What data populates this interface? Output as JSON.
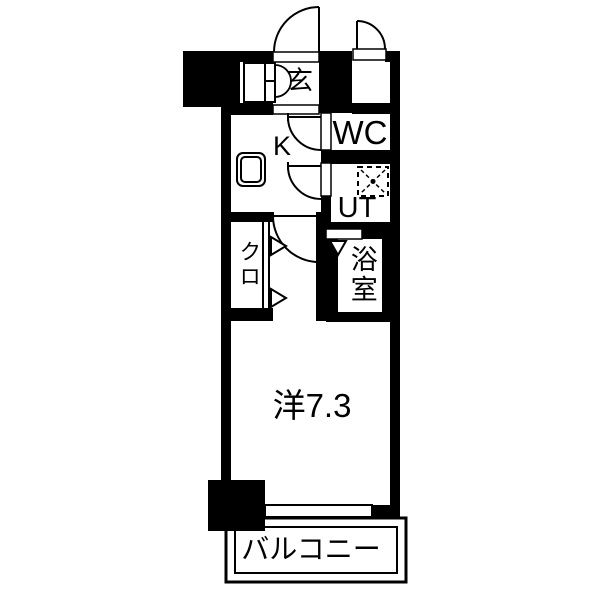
{
  "title": "apartment-floor-plan",
  "colors": {
    "wall": "#000000",
    "background": "#ffffff",
    "line": "#000000"
  },
  "rooms": {
    "genkan": {
      "label": "玄"
    },
    "kitchen": {
      "label": "K"
    },
    "wc": {
      "label": "WC"
    },
    "utility": {
      "label": "UT"
    },
    "bath": {
      "label": "浴室"
    },
    "closet": {
      "label": "クロ"
    },
    "main_room": {
      "label": "洋7.3"
    },
    "balcony": {
      "label": "バルコニー"
    }
  },
  "symbols": {
    "entrance_door": "swing-door-arc",
    "meter_box_door": "swing-door-arc",
    "wc_door": "swing-door-arc",
    "utility_door": "swing-door-arc",
    "room_door": "swing-door-arc",
    "closet_door": "folding-door-triangles",
    "bath_door": "triangle-marker",
    "shoe_cabinet": "double-arc-cabinet",
    "kitchen_sink": "rounded-square",
    "washing_machine": "dashed-square-with-cross",
    "window": "double-line-opening"
  }
}
